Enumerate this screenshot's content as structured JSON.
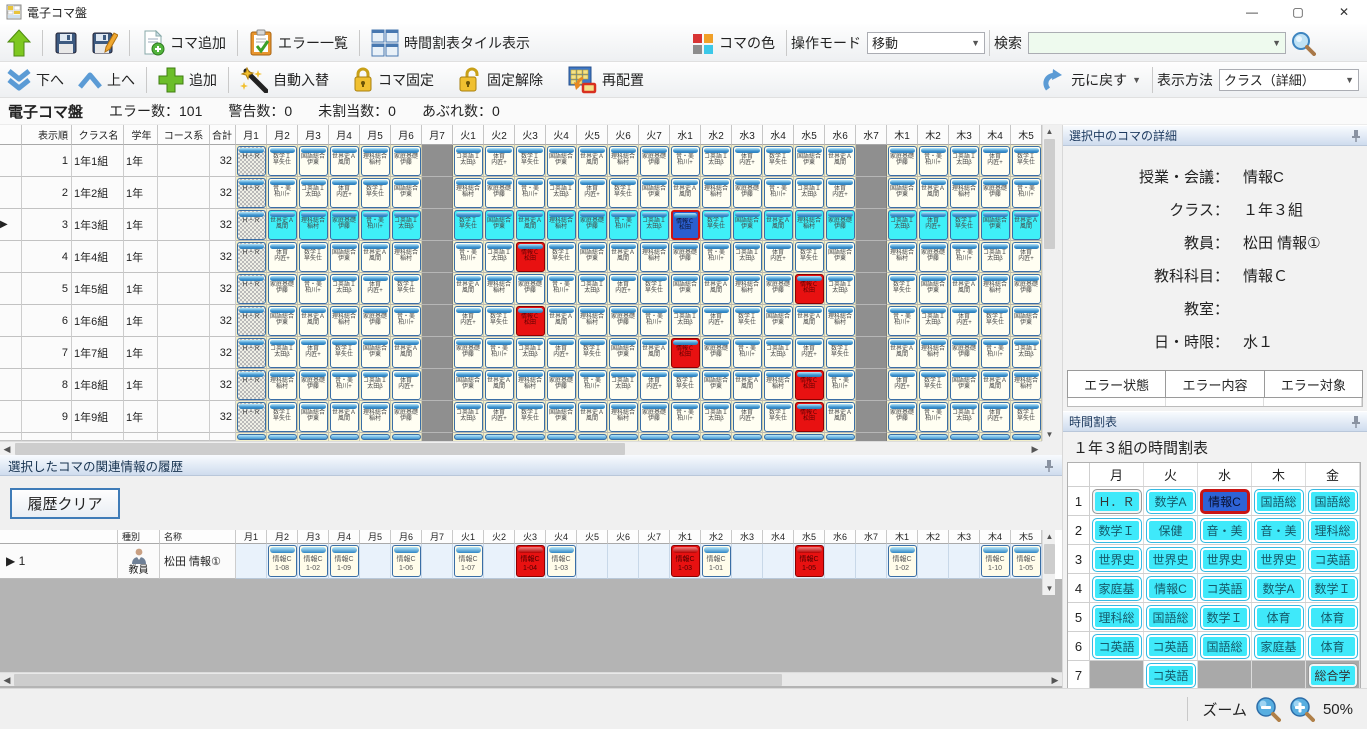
{
  "window": {
    "title": "電子コマ盤",
    "minimize": "—",
    "maximize": "▢",
    "close": "✕"
  },
  "toolbar_main": {
    "koma_add": "コマ追加",
    "error_list": "エラー一覧",
    "tile_view": "時間割表タイル表示",
    "koma_color": "コマの色",
    "mode_label": "操作モード",
    "mode_value": "移動",
    "search_label": "検索",
    "search_value": ""
  },
  "toolbar_edit": {
    "down": "下へ",
    "up": "上へ",
    "add": "追加",
    "auto_swap": "自動入替",
    "koma_fix": "コマ固定",
    "fix_release": "固定解除",
    "rearrange": "再配置",
    "undo": "元に戻す",
    "view_label": "表示方法",
    "view_value": "クラス（詳細）"
  },
  "status_strip": {
    "app": "電子コマ盤",
    "errors": "エラー数：101",
    "warnings": "警告数：0",
    "unassigned": "未割当数：0",
    "overflow": "あぶれ数：0"
  },
  "grid": {
    "fixed_headers": [
      "表示順",
      "クラス名",
      "学年",
      "コース系",
      "合計"
    ],
    "day_headers": [
      "月1",
      "月2",
      "月3",
      "月4",
      "月5",
      "月6",
      "月7",
      "火1",
      "火2",
      "火3",
      "火4",
      "火5",
      "火6",
      "火7",
      "水1",
      "水2",
      "水3",
      "水4",
      "水5",
      "水6",
      "水7",
      "木1",
      "木2",
      "木3",
      "木4",
      "木5"
    ],
    "hr_label": "Ｈ・Ｒ",
    "subjects": [
      [
        "世界史Ａ",
        "風間"
      ],
      [
        "国語総合",
        "伊東"
      ],
      [
        "数学Ｉ",
        "早矢仕"
      ],
      [
        "体育",
        "内匠+"
      ],
      [
        "コ英語Ｉ",
        "太田β"
      ],
      [
        "音・美",
        "柏川+"
      ],
      [
        "家庭基礎",
        "伊藤"
      ],
      [
        "理科総合",
        "稲村"
      ],
      [
        "保健",
        "浜田"
      ],
      [
        "情報Ｃ",
        "松田"
      ]
    ],
    "rows": [
      {
        "order": "1",
        "name": "1年1組",
        "grade": "1年",
        "course": "",
        "total": "32",
        "selected": false,
        "cells": [
          "h",
          "n2",
          "n1",
          "n0",
          "n7",
          "n6",
          "g",
          "n4",
          "n3",
          "n2",
          "n1",
          "n0",
          "n7",
          "n6",
          "n5",
          "n4",
          "n3",
          "n2",
          "n1",
          "n0",
          "g",
          "n6",
          "n5",
          "n4",
          "n3",
          "n2"
        ]
      },
      {
        "order": "2",
        "name": "1年2組",
        "grade": "1年",
        "course": "",
        "total": "32",
        "selected": false,
        "cells": [
          "h",
          "n5",
          "n4",
          "n3",
          "n2",
          "n1",
          "g",
          "n7",
          "n6",
          "n5",
          "n4",
          "n3",
          "n2",
          "n1",
          "n0",
          "n7",
          "n6",
          "n5",
          "n4",
          "n3",
          "g",
          "n1",
          "n0",
          "n7",
          "n6",
          "n5"
        ]
      },
      {
        "order": "3",
        "name": "1年3組",
        "grade": "1年",
        "course": "",
        "total": "32",
        "selected": true,
        "cells": [
          "h",
          "c0",
          "c7",
          "c6",
          "c5",
          "c4",
          "g",
          "c2",
          "c1",
          "c0",
          "c7",
          "c6",
          "c5",
          "c4",
          "x",
          "c2",
          "c1",
          "c0",
          "c7",
          "c6",
          "g",
          "c4",
          "c3",
          "c2",
          "c1",
          "c0"
        ]
      },
      {
        "order": "4",
        "name": "1年4組",
        "grade": "1年",
        "course": "",
        "total": "32",
        "selected": false,
        "cells": [
          "h",
          "n3",
          "n2",
          "n1",
          "n0",
          "n7",
          "g",
          "n5",
          "n4",
          "r",
          "n2",
          "n1",
          "n0",
          "n7",
          "n6",
          "n5",
          "n4",
          "n3",
          "n2",
          "n1",
          "g",
          "n7",
          "n6",
          "n5",
          "n4",
          "n3"
        ]
      },
      {
        "order": "5",
        "name": "1年5組",
        "grade": "1年",
        "course": "",
        "total": "32",
        "selected": false,
        "cells": [
          "h",
          "n6",
          "n5",
          "n4",
          "n3",
          "n2",
          "g",
          "n0",
          "n7",
          "n6",
          "n5",
          "n4",
          "n3",
          "n2",
          "n1",
          "n0",
          "n7",
          "n6",
          "r",
          "n4",
          "g",
          "n2",
          "n1",
          "n0",
          "n7",
          "n6"
        ]
      },
      {
        "order": "6",
        "name": "1年6組",
        "grade": "1年",
        "course": "",
        "total": "32",
        "selected": false,
        "cells": [
          "h",
          "n1",
          "n0",
          "n7",
          "n6",
          "n5",
          "g",
          "n3",
          "n2",
          "r",
          "n0",
          "n7",
          "n6",
          "n5",
          "n4",
          "n3",
          "n2",
          "n1",
          "n0",
          "n7",
          "g",
          "n5",
          "n4",
          "n3",
          "n2",
          "n1"
        ]
      },
      {
        "order": "7",
        "name": "1年7組",
        "grade": "1年",
        "course": "",
        "total": "32",
        "selected": false,
        "cells": [
          "h",
          "n4",
          "n3",
          "n2",
          "n1",
          "n0",
          "g",
          "n6",
          "n5",
          "n4",
          "n3",
          "n2",
          "n1",
          "n0",
          "r",
          "n6",
          "n5",
          "n4",
          "n3",
          "n2",
          "g",
          "n0",
          "n7",
          "n6",
          "n5",
          "n4"
        ]
      },
      {
        "order": "8",
        "name": "1年8組",
        "grade": "1年",
        "course": "",
        "total": "32",
        "selected": false,
        "cells": [
          "h",
          "n7",
          "n6",
          "n5",
          "n4",
          "n3",
          "g",
          "n1",
          "n0",
          "n7",
          "n6",
          "n5",
          "n4",
          "n3",
          "n2",
          "n1",
          "n0",
          "n7",
          "r",
          "n5",
          "g",
          "n3",
          "n2",
          "n1",
          "n0",
          "n7"
        ]
      },
      {
        "order": "9",
        "name": "1年9組",
        "grade": "1年",
        "course": "",
        "total": "32",
        "selected": false,
        "cells": [
          "h",
          "n2",
          "n1",
          "n0",
          "n7",
          "n6",
          "g",
          "n4",
          "n3",
          "n2",
          "n1",
          "n0",
          "n7",
          "n6",
          "n5",
          "n4",
          "n3",
          "n2",
          "r",
          "n0",
          "g",
          "n6",
          "n5",
          "n4",
          "n3",
          "n2"
        ]
      }
    ]
  },
  "detail_panel": {
    "title": "選択中のコマの詳細",
    "fields": [
      {
        "label": "授業・会議：",
        "value": "情報C"
      },
      {
        "label": "クラス：",
        "value": "１年３組"
      },
      {
        "label": "教員：",
        "value": "松田 情報①"
      },
      {
        "label": "教科科目：",
        "value": "情報Ｃ"
      },
      {
        "label": "教室：",
        "value": ""
      },
      {
        "label": "日・時限：",
        "value": "水１"
      }
    ]
  },
  "error_table": {
    "headers": [
      "エラー状態",
      "エラー内容",
      "エラー対象"
    ]
  },
  "timetable_panel": {
    "title": "時間割表",
    "subtitle": "１年３組の時間割表",
    "days": [
      "月",
      "火",
      "水",
      "木",
      "金"
    ],
    "periods": [
      "1",
      "2",
      "3",
      "4",
      "5",
      "6",
      "7"
    ],
    "cells": [
      [
        "hr:Ｈ．Ｒ",
        "n:数学A",
        "sel:情報C",
        "n:国語総",
        "n:国語総"
      ],
      [
        "n:数学Ｉ",
        "n:保健",
        "n:音・美",
        "n:音・美",
        "n:理科総"
      ],
      [
        "n:世界史",
        "n:世界史",
        "n:世界史",
        "n:世界史",
        "n:コ英語"
      ],
      [
        "n:家庭基",
        "n:情報C",
        "n:コ英語",
        "n:数学A",
        "n:数学Ｉ"
      ],
      [
        "n:理科総",
        "n:国語総",
        "n:数学Ｉ",
        "n:体育",
        "n:体育"
      ],
      [
        "n:コ英語",
        "n:コ英語",
        "n:国語総",
        "n:家庭基",
        "n:体育"
      ],
      [
        "g:",
        "n:コ英語",
        "g:",
        "g:",
        "hatch:総合学"
      ]
    ]
  },
  "history_panel": {
    "title": "選択したコマの関連情報の履歴",
    "clear_button": "履歴クリア",
    "col_type": "種別",
    "col_name": "名称",
    "tile_subject": "情報C",
    "row": {
      "num": "1",
      "type": "教員",
      "name": "松田 情報①",
      "cells": [
        "",
        "1-08",
        "1-02",
        "1-09",
        "",
        "1-06",
        "",
        "1-07",
        "",
        "R1-04",
        "1-03",
        "",
        "",
        "",
        "R1-03",
        "1-01",
        "",
        "",
        "R1-05",
        "",
        "",
        "1-02",
        "",
        "",
        "1-10",
        "1-05"
      ]
    }
  },
  "statusbar": {
    "zoom_label": "ズーム",
    "zoom_value": "50%"
  }
}
